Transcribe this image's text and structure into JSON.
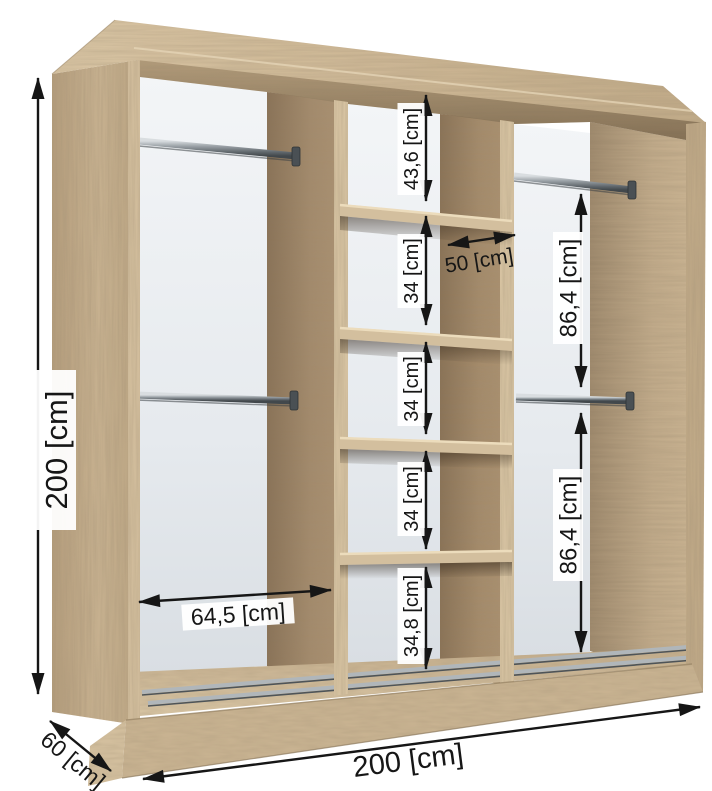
{
  "diagram": {
    "type": "wardrobe-interior-dimension-diagram",
    "units": "cm",
    "labels": {
      "overall_height": "200 [cm]",
      "overall_width": "200 [cm]",
      "overall_depth": "60 [cm]",
      "left_section_width": "64,5 [cm]",
      "shelf_column_width": "50 [cm]",
      "shelf_gap_top": "43,6 [cm]",
      "shelf_gap_1": "34 [cm]",
      "shelf_gap_2": "34 [cm]",
      "shelf_gap_3": "34 [cm]",
      "shelf_gap_bottom": "34,8 [cm]",
      "right_gap_upper": "86,4 [cm]",
      "right_gap_lower": "86,4 [cm]"
    },
    "colors": {
      "wood_light": "#d6c2a1",
      "wood_mid": "#c7b190",
      "wood_dark": "#a88f6f",
      "back_panel": "#e9edf0",
      "rail_metal": "#9aa1a6",
      "dimension": "#161616"
    }
  }
}
